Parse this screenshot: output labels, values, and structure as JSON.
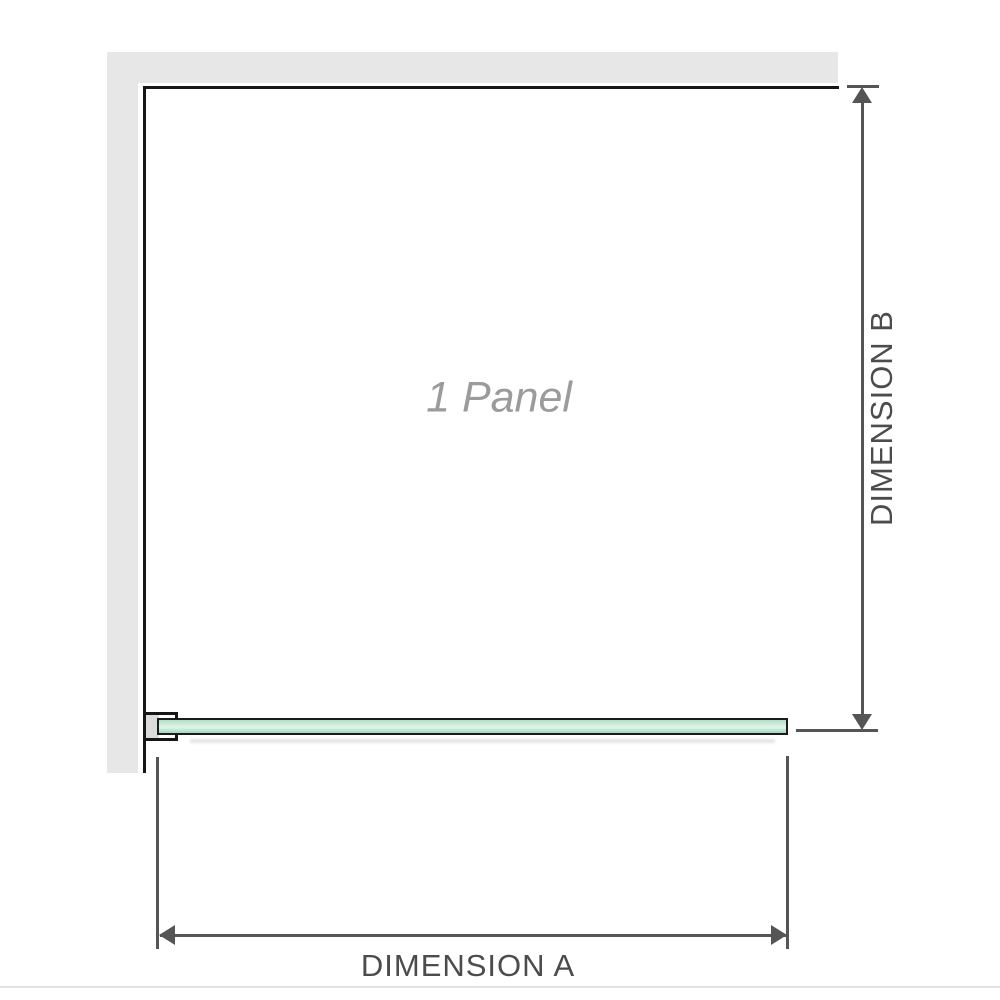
{
  "labels": {
    "panel": "1 Panel",
    "dimension_a": "DIMENSION A",
    "dimension_b": "DIMENSION B"
  },
  "colors": {
    "wall_gray": "#e7e7e7",
    "outline_black": "#161616",
    "dimension_gray": "#555555",
    "glass_border": "#1c1c1c",
    "glass_green": "#aee0c6",
    "glass_green_light": "#d6f0e0",
    "glass_green_dark": "#9fd8bd",
    "panel_label_gray": "#9b9b9b",
    "dimension_text_gray": "#4c4c4c"
  }
}
